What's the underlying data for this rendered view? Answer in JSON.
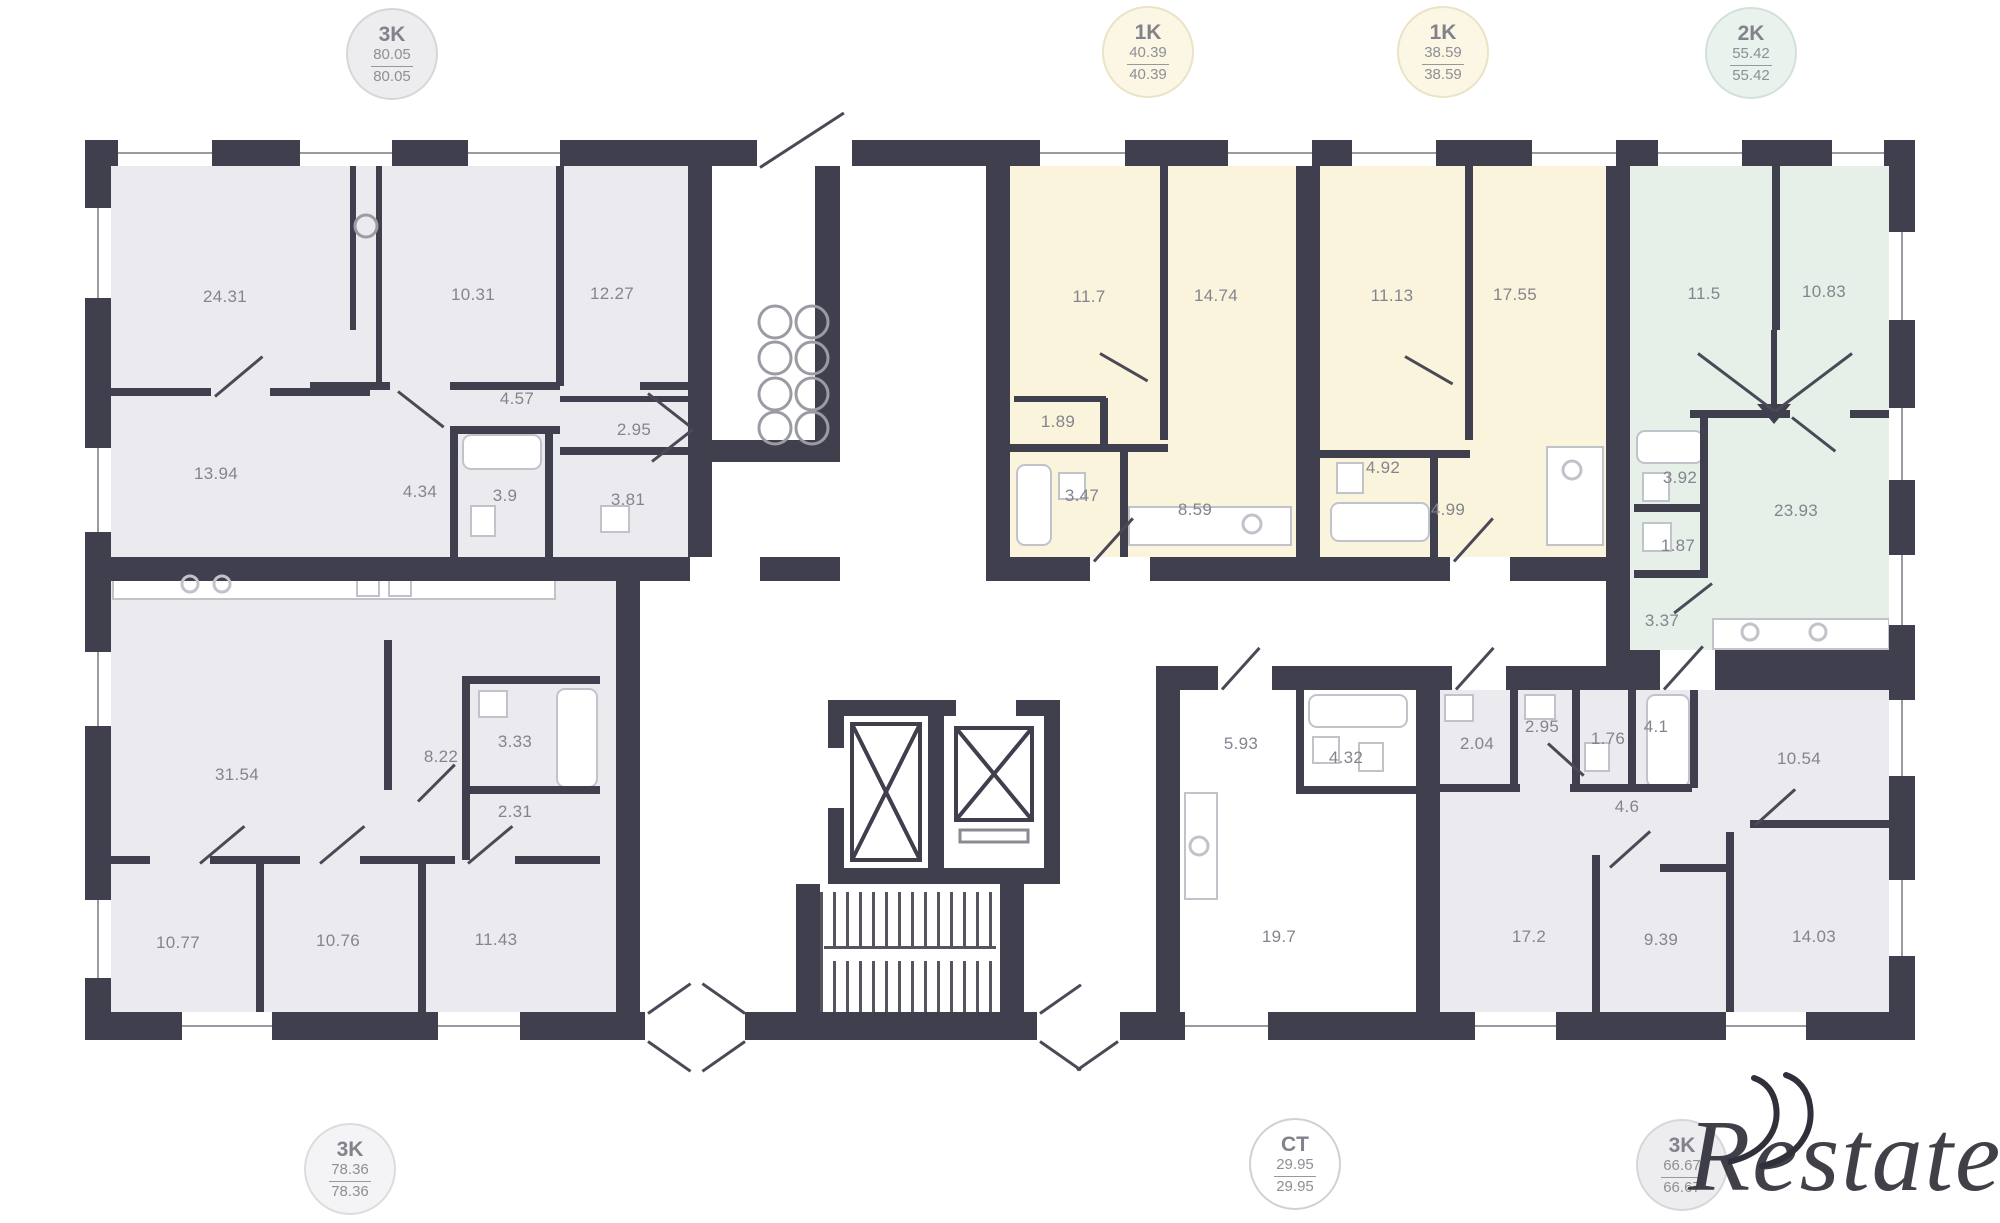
{
  "badges": {
    "top": [
      {
        "kind": "3K",
        "area_total": "80.05",
        "area_living": "80.05"
      },
      {
        "kind": "1K",
        "area_total": "40.39",
        "area_living": "40.39"
      },
      {
        "kind": "1K",
        "area_total": "38.59",
        "area_living": "38.59"
      },
      {
        "kind": "2K",
        "area_total": "55.42",
        "area_living": "55.42"
      }
    ],
    "bottom": [
      {
        "kind": "3K",
        "area_total": "78.36",
        "area_living": "78.36"
      },
      {
        "kind": "CT",
        "area_total": "29.95",
        "area_living": "29.95"
      },
      {
        "kind": "3K",
        "area_total": "66.67",
        "area_living": "66.67"
      }
    ]
  },
  "apartments": {
    "apt_3k_80": {
      "rooms": [
        "24.31",
        "10.31",
        "12.27",
        "4.57",
        "2.95",
        "13.94",
        "4.34",
        "3.9",
        "3.81"
      ]
    },
    "apt_3k_78": {
      "rooms": [
        "31.54",
        "8.22",
        "3.33",
        "2.31",
        "10.77",
        "10.76",
        "11.43"
      ]
    },
    "apt_1k_40": {
      "rooms": [
        "11.7",
        "14.74",
        "1.89",
        "3.47",
        "8.59"
      ]
    },
    "apt_1k_38": {
      "rooms": [
        "11.13",
        "17.55",
        "4.92",
        "4.99"
      ]
    },
    "apt_2k_55": {
      "rooms": [
        "11.5",
        "10.83",
        "3.92",
        "23.93",
        "1.87",
        "3.37"
      ]
    },
    "apt_ct_29": {
      "rooms": [
        "5.93",
        "4.32",
        "19.7"
      ]
    },
    "apt_3k_66": {
      "rooms": [
        "2.04",
        "2.95",
        "1.76",
        "4.1",
        "10.54",
        "4.6",
        "17.2",
        "9.39",
        "14.03"
      ]
    }
  },
  "watermark": {
    "text": "Restate"
  },
  "colors": {
    "wall": "#403f4d",
    "fill_gray": "#ebebef",
    "fill_yellow": "#faf4dd",
    "fill_green": "#e6f0e9",
    "label_text": "#84848e"
  }
}
